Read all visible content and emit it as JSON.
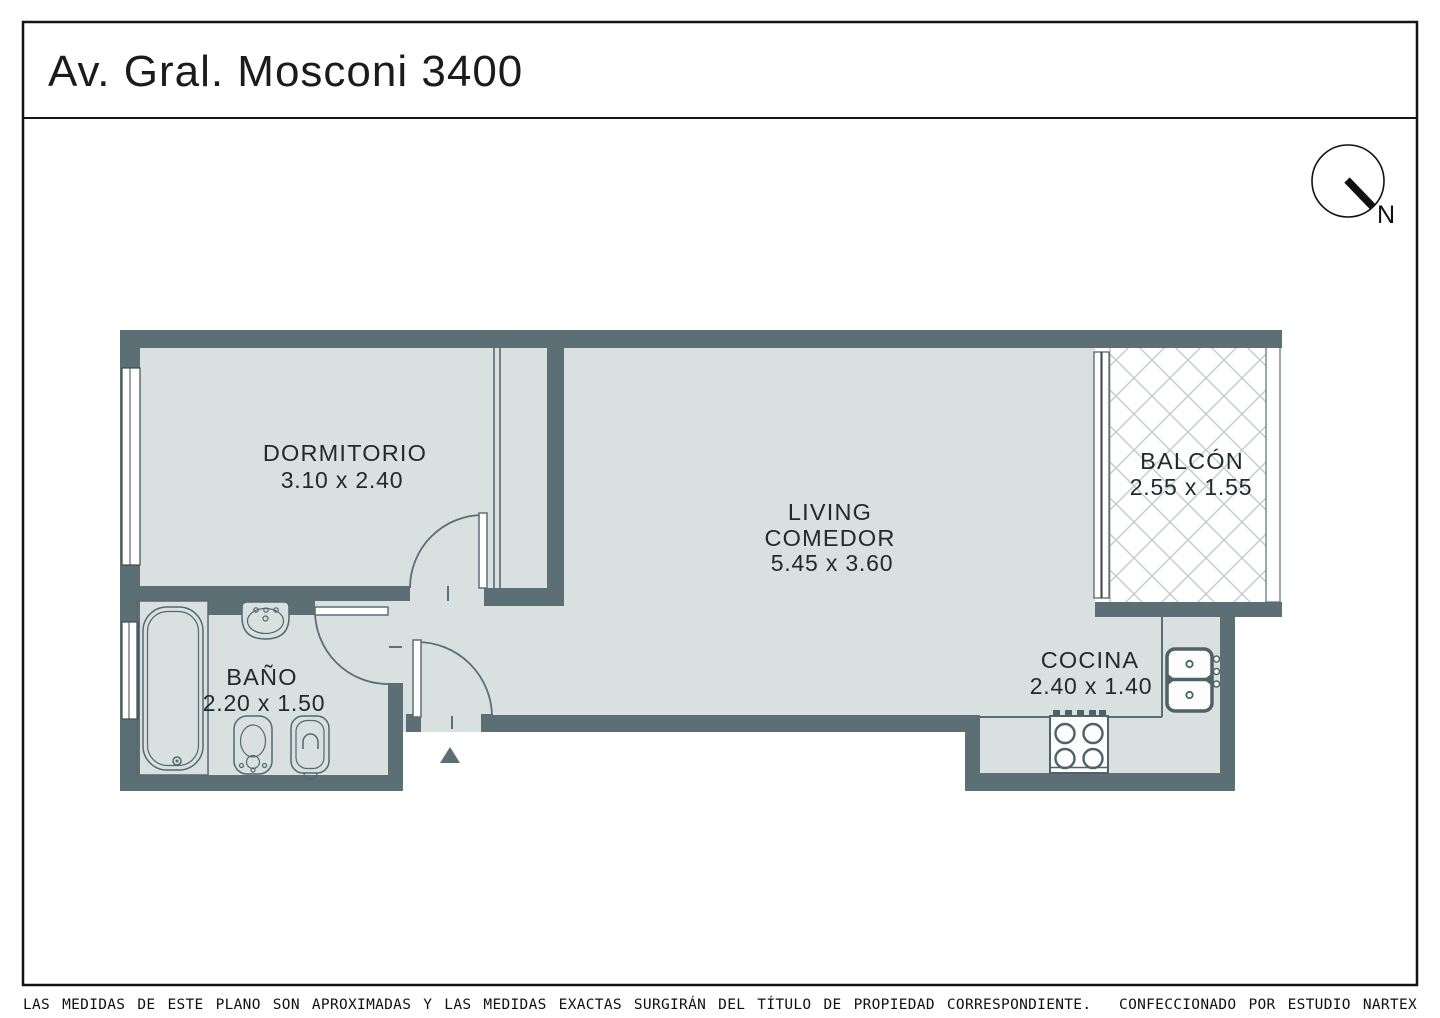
{
  "title": "Av. Gral. Mosconi 3400",
  "compass": {
    "label": "N"
  },
  "rooms": {
    "dormitorio": {
      "name": "DORMITORIO",
      "dims": "3.10 x 2.40"
    },
    "living": {
      "line1": "LIVING",
      "line2": "COMEDOR",
      "dims": "5.45 x 3.60"
    },
    "balcon": {
      "name": "BALCÓN",
      "dims": "2.55 x 1.55"
    },
    "bano": {
      "name": "BAÑO",
      "dims": "2.20 x 1.50"
    },
    "cocina": {
      "name": "COCINA",
      "dims": "2.40 x 1.40"
    }
  },
  "footer": {
    "disclaimer": "LAS MEDIDAS  DE ESTE PLANO SON APROXIMADAS Y LAS MEDIDAS EXACTAS SURGIRÁN DEL TÍTULO DE PROPIEDAD CORRESPONDIENTE.",
    "credit": "CONFECCIONADO POR ESTUDIO NARTEX"
  },
  "colors": {
    "wall": "#5b6f75",
    "floor": "#d9e0e0",
    "hatch": "#c6cdce",
    "frame": "#141414",
    "label": "#24292b"
  }
}
